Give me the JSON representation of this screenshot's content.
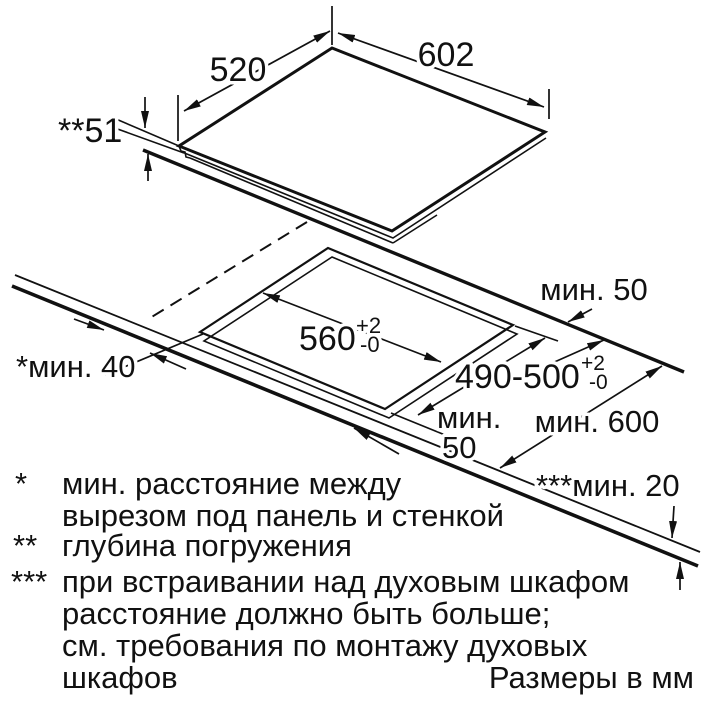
{
  "labels": {
    "panel_width": "602",
    "panel_depth": "520",
    "recess_depth": "**51",
    "cutout_width": "560",
    "cutout_width_tol_plus": "+2",
    "cutout_width_tol_minus": "-0",
    "cutout_depth": "490-500",
    "cutout_depth_tol_plus": "+2",
    "cutout_depth_tol_minus": "-0",
    "back_clearance": "мин. 50",
    "side_clearance": "*мин. 40",
    "front_clearance_line1": "мин.",
    "front_clearance_line2": "50",
    "worktop_depth": "мин. 600",
    "bottom_clearance": "***мин. 20"
  },
  "footnotes": [
    {
      "marker": "*",
      "lines": [
        "мин. расстояние между",
        "вырезом под панель и стенкой"
      ]
    },
    {
      "marker": "**",
      "lines": [
        "глубина погружения"
      ]
    },
    {
      "marker": "***",
      "lines": [
        "при встраивании над духовым шкафом",
        "расстояние должно быть больше;",
        "см. требования по монтажу духовых",
        "шкафов"
      ]
    }
  ],
  "units_note": "Размеры в мм",
  "colors": {
    "ink": "#111111",
    "background": "#ffffff"
  }
}
